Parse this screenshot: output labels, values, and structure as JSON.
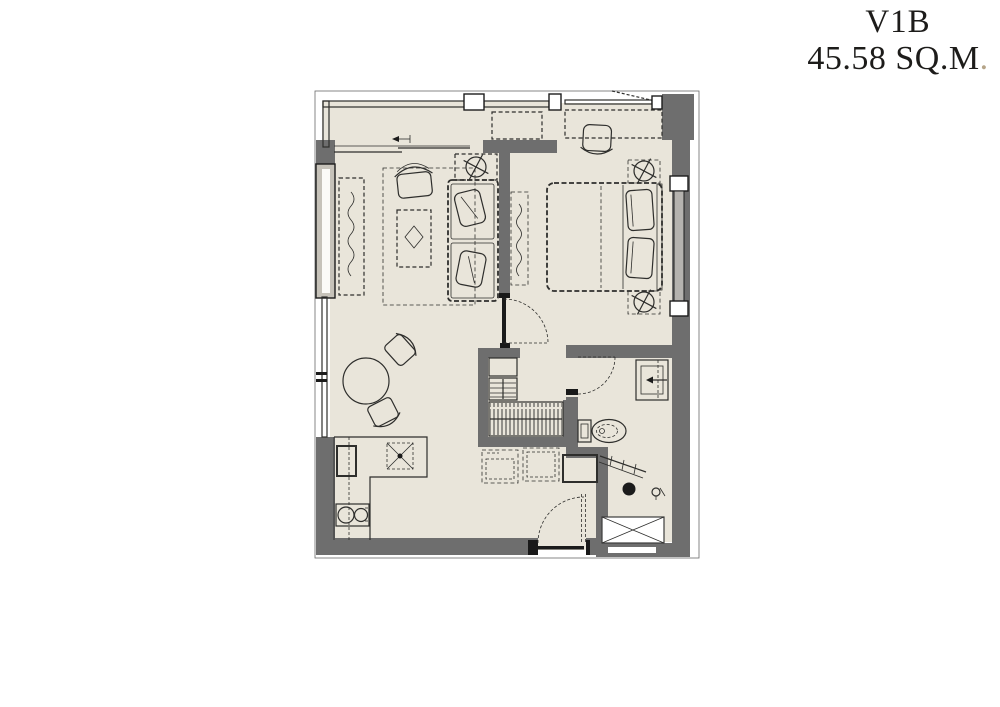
{
  "header": {
    "unit_type": "V1B",
    "area": "45.58 SQ.M",
    "area_dot": "."
  },
  "colors": {
    "background": "#ffffff",
    "floor": "#e9e5da",
    "wall": "#6e6e6e",
    "line": "#2e2e2c",
    "glass": "#b5b3af",
    "window_fill": "#c6c2b9",
    "accent_dot": "#b5a488"
  }
}
